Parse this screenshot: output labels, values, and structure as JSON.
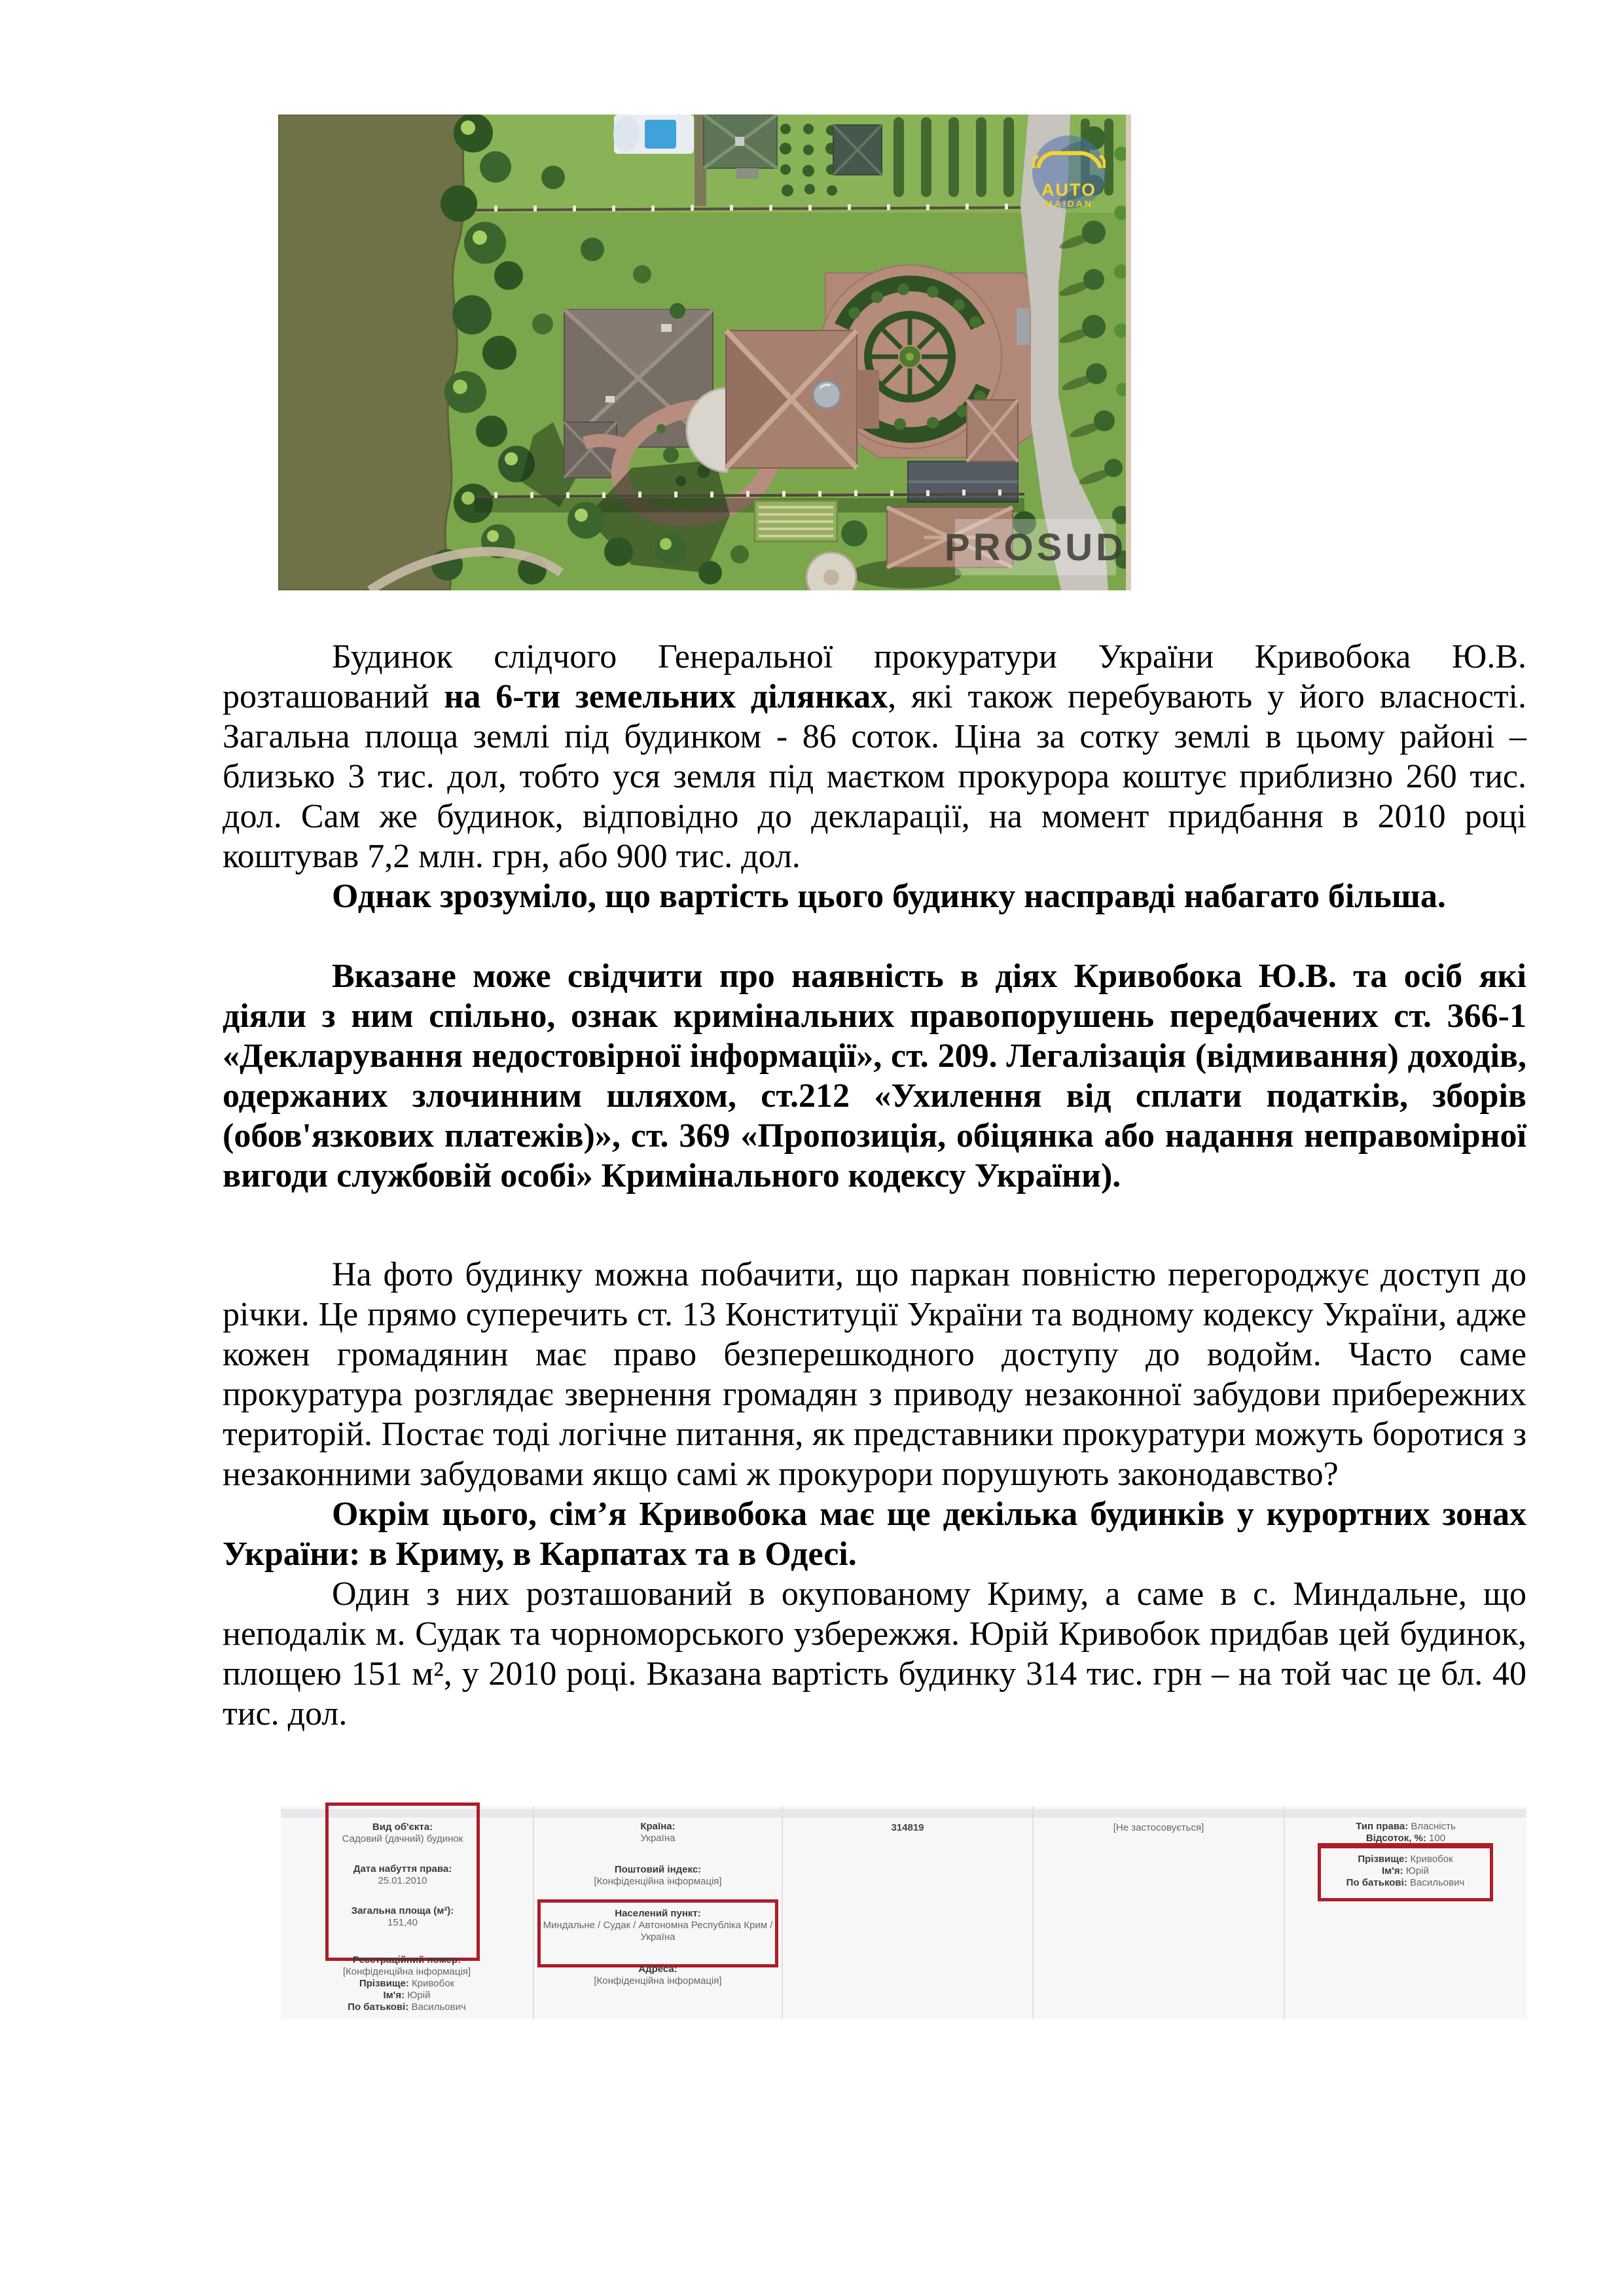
{
  "photo": {
    "description": "aerial-view-of-prosecutor-estate-by-river",
    "watermark_logo": {
      "line1": "AUTO",
      "line2": "MAIDAN"
    },
    "watermark_text": "PROSUD",
    "colors": {
      "water": "#6f7146",
      "lawn": "#7ca64b",
      "roof_mauve": "#a8806f",
      "roof_gray": "#776e66",
      "road": "#c7c3bd",
      "hedge": "#2f5124",
      "path_brick": "#b68d7e"
    }
  },
  "paragraphs": {
    "p1": {
      "part1": "Будинок слідчого Генеральної прокуратури України Кривобока Ю.В. розташований ",
      "bold": "на 6-ти земельних ділянках",
      "part2": ", які також перебувають у його власності. Загальна площа землі під будинком - 86 соток. Ціна за сотку землі в цьому районі – близько 3 тис. дол, тобто уся земля під маєтком прокурора коштує приблизно 260 тис. дол. Сам же будинок, відповідно до декларації, на момент придбання в 2010 році коштував  7,2 млн. грн, або 900 тис. дол."
    },
    "p2": "Однак зрозуміло, що вартість цього будинку насправді набагато більша.",
    "p3": "Вказане може свідчити про наявність в діях Кривобока Ю.В. та осіб які діяли з ним спільно, ознак кримінальних правопорушень передбачених ст. 366-1 «Декларування недостовірної інформації», ст. 209. Легалізація (відмивання) доходів, одержаних злочинним шляхом, ст.212 «Ухилення від сплати податків, зборів (обов'язкових платежів)», ст. 369 «Пропозиція, обіцянка або надання неправомірної вигоди службовій особі» Кримінального кодексу України).",
    "p4": "На фото будинку можна побачити, що паркан повністю перегороджує доступ до річки.  Це прямо суперечить ст. 13 Конституції України та водному кодексу України, адже кожен громадянин має право безперешкодного доступу до водойм. Часто саме прокуратура розглядає звернення громадян з приводу незаконної забудови прибережних територій. Постає тоді логічне питання, як представники прокуратури можуть боротися з незаконними забудовами якщо самі ж прокурори порушують законодавство?",
    "p5": "Окрім цього, сім’я Кривобока має ще декілька будинків у курортних зонах України: в Криму, в Карпатах та в Одесі.",
    "p6": "Один з них розташований в окупованому Криму, а саме в с. Миндальне, що неподалік м. Судак та чорноморського узбережжя. Юрій Кривобок придбав цей будинок, площею 151 м²,  у 2010 році.  Вказана вартість будинку 314 тис. грн – на той час це бл. 40 тис. дол."
  },
  "registry": {
    "accent_red": "#ae1c28",
    "col1": {
      "object_type_label": "Вид об'єкта:",
      "object_type_value": "Садовий (дачний) будинок",
      "date_label": "Дата набуття права:",
      "date_value": "25.01.2010",
      "area_label": "Загальна площа (м²):",
      "area_value": "151,40",
      "reg_number_label": "Реєстраційний номер:",
      "reg_number_value": "[Конфіденційна інформація]",
      "surname_label": "Прізвище:",
      "surname_value": "Кривобок",
      "name_label": "Ім'я:",
      "name_value": "Юрій",
      "patronymic_label": "По батькові:",
      "patronymic_value": "Васильович"
    },
    "col2": {
      "country_label": "Країна:",
      "country_value": "Україна",
      "postal_label": "Поштовий індекс:",
      "postal_value": "[Конфіденційна інформація]",
      "settlement_label": "Населений пункт:",
      "settlement_value": "Миндальне / Судак / Автономна Республіка Крим / Україна",
      "address_label": "Адреса:",
      "address_value": "[Конфіденційна інформація]"
    },
    "col3": {
      "id_value": "314819"
    },
    "col4": {
      "note_value": "[Не застосовується]"
    },
    "col5": {
      "right_type_label": "Тип права:",
      "right_type_value": "Власність",
      "percent_label": "Відсоток, %:",
      "percent_value": "100",
      "surname_label": "Прізвище:",
      "surname_value": "Кривобок",
      "name_label": "Ім'я:",
      "name_value": "Юрій",
      "patronymic_label": "По батькові:",
      "patronymic_value": "Васильович"
    }
  }
}
